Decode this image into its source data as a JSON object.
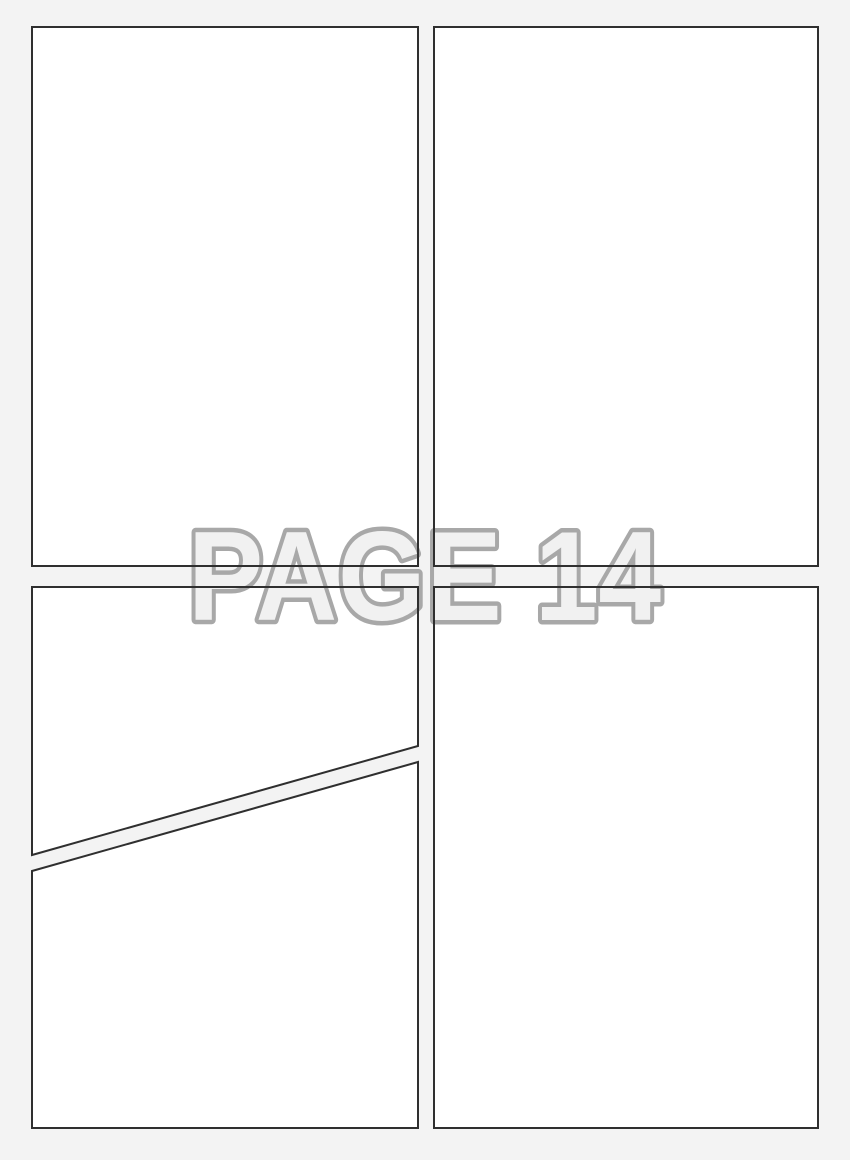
{
  "page": {
    "watermark_label": "PAGE 14",
    "background_color": "#f3f3f3",
    "panel_fill_color": "#ffffff",
    "panel_border_color": "#2f2f2f",
    "watermark_fill_color": "#f1f1f1",
    "watermark_outline_color": "#a8a8a8"
  },
  "panels": [
    {
      "name": "top-left"
    },
    {
      "name": "top-right"
    },
    {
      "name": "bottom-left-upper-diagonal"
    },
    {
      "name": "bottom-left-lower-diagonal"
    },
    {
      "name": "bottom-right"
    }
  ]
}
